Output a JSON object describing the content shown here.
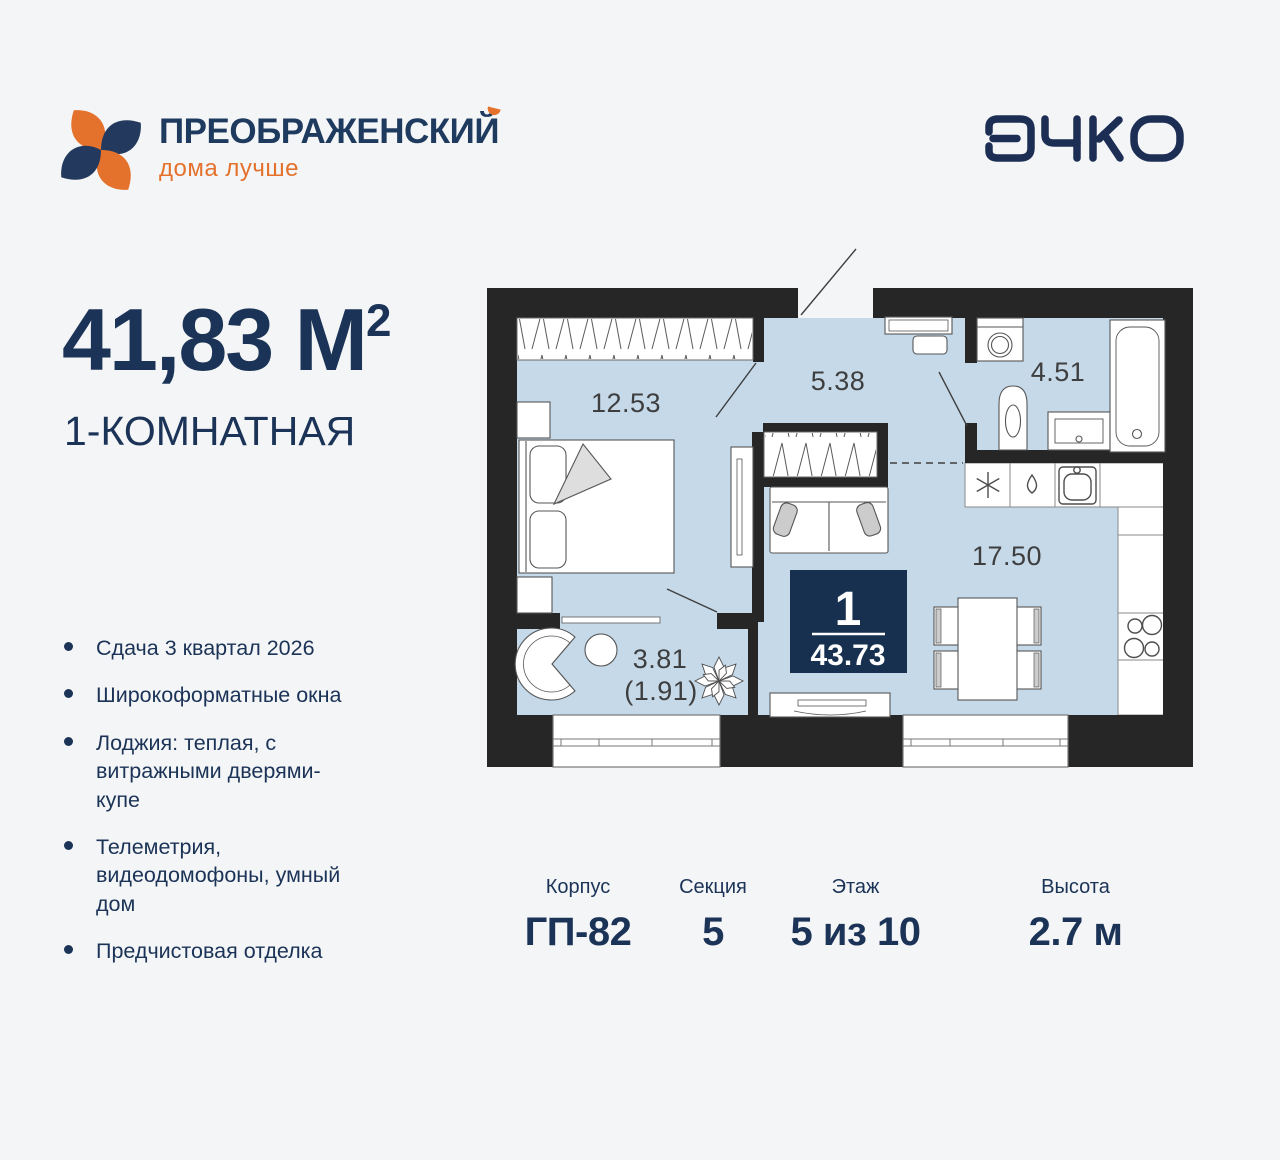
{
  "header": {
    "brand_name": "ПРЕОБРАЖЕНСКИЙ",
    "brand_tagline": "дома лучше",
    "developer_logo": "ЭНКО"
  },
  "summary": {
    "area_value": "41,83 М",
    "area_sup": "2",
    "flat_type": "1-КОМНАТНАЯ"
  },
  "features": [
    "Сдача 3 квартал 2026",
    "Широкоформатные окна",
    "Лоджия: теплая, с витражными дверями-купе",
    "Телеметрия, видеодомофоны, умный дом",
    "Предчистовая отделка"
  ],
  "plan": {
    "rooms": [
      {
        "name": "bedroom",
        "area": "12.53"
      },
      {
        "name": "hallway",
        "area": "5.38"
      },
      {
        "name": "bathroom",
        "area": "4.51"
      },
      {
        "name": "kitchen-living",
        "area": "17.50"
      },
      {
        "name": "loggia",
        "area": "3.81",
        "area_reduced": "(1.91)"
      }
    ],
    "badge": {
      "rooms": "1",
      "total_area": "43.73"
    }
  },
  "details": {
    "columns": [
      {
        "label": "Корпус",
        "value": "ГП-82"
      },
      {
        "label": "Секция",
        "value": "5"
      },
      {
        "label": "Этаж",
        "value": "5 из 10"
      },
      {
        "label": "Высота",
        "value": "2.7 м"
      }
    ]
  },
  "colors": {
    "navy_text": "#1b3357",
    "orange_accent": "#e4722d",
    "wall": "#262626",
    "room_fill": "#c5d9e9",
    "badge_fill": "#17304f",
    "background": "#f4f5f6"
  }
}
